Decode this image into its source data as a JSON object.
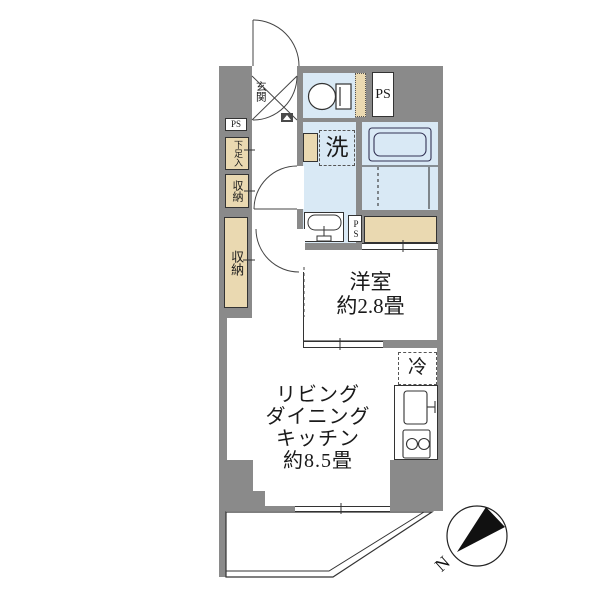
{
  "floorplan": {
    "colors": {
      "wall": "#8a8a8a",
      "wet": "#d9e9f5",
      "storage": "#ead9b1",
      "line": "#333333"
    },
    "labels": {
      "entrance": "玄関",
      "ps_entrance": "PS",
      "shoe_cabinet": "下足入",
      "storage_upper": "収納",
      "storage_lower": "収納",
      "ps_bath": "PS",
      "laundry": "洗",
      "ps_middle": "PS",
      "western_room_name": "洋室",
      "western_room_size": "約2.8畳",
      "ldk_line1": "リビング",
      "ldk_line2": "ダイニング",
      "ldk_line3": "キッチン",
      "ldk_size": "約8.5畳",
      "refrigerator": "冷",
      "balcony": "バルコニー",
      "compass_north": "N"
    }
  }
}
